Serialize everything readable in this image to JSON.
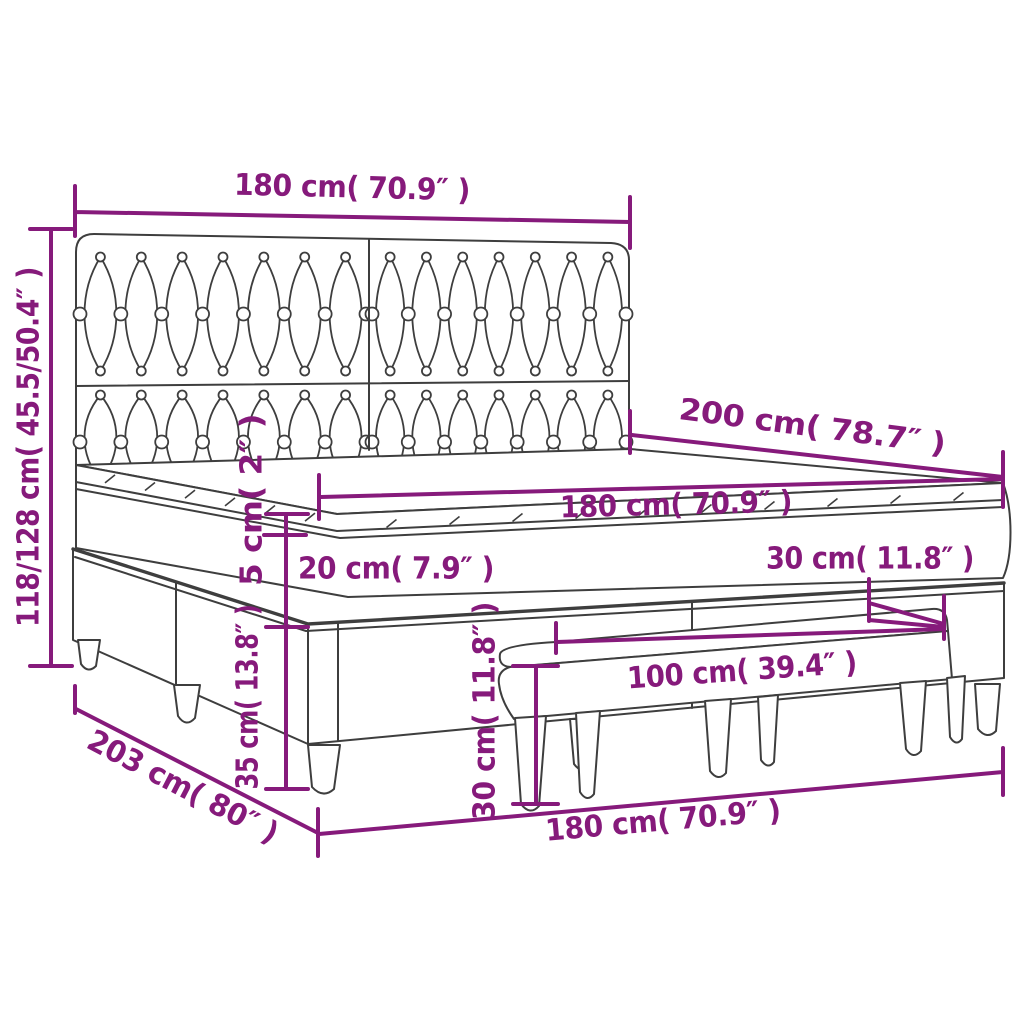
{
  "diagram": {
    "type": "product-dimension-diagram",
    "subject": "box-spring-bed-with-headboard-and-bench",
    "colors": {
      "dimension": "#861a7b",
      "outline": "#3e3e3e",
      "background": "#ffffff"
    },
    "dimensions": {
      "headboard_width": "180 cm( 70.9″ )",
      "total_height": "118/128 cm( 45.5/50.4″ )",
      "bed_length": "200 cm( 78.7″ )",
      "mattress_width": "180 cm( 70.9″ )",
      "topper_height": "5 cm( 2″ )",
      "mattress_height": "20 cm( 7.9″ )",
      "base_height": "35 cm( 13.8″ )",
      "bench_depth": "30 cm( 11.8″ )",
      "bench_width": "100 cm( 39.4″ )",
      "bench_height": "30 cm( 11.8″ )",
      "base_width": "180 cm( 70.9″ )",
      "floor_depth": "203 cm( 80″ )"
    }
  }
}
